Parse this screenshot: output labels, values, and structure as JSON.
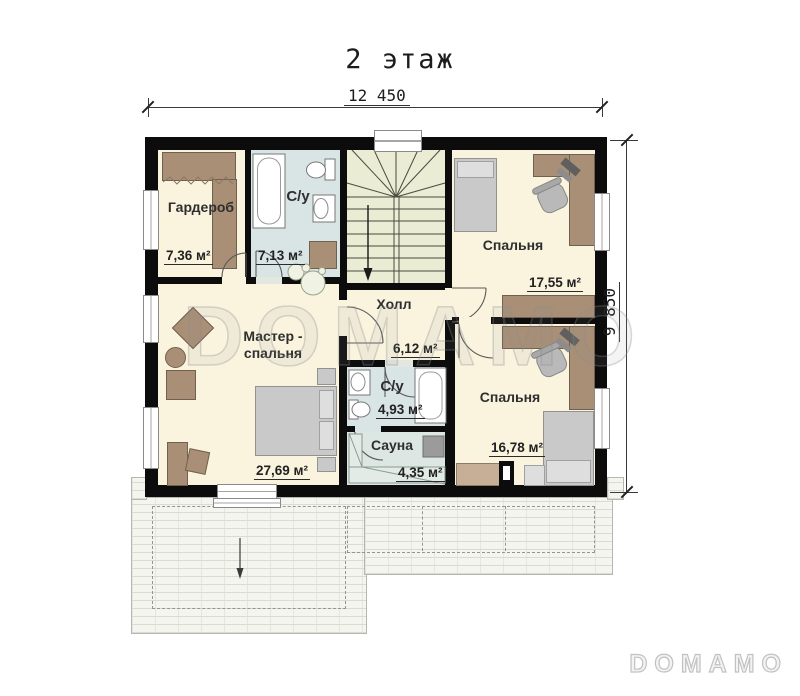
{
  "title": "2 этаж",
  "dimensions": {
    "width": "12 450",
    "height": "9 850"
  },
  "rooms": [
    {
      "name": "Гардероб",
      "area": "7,36 м²"
    },
    {
      "name": "С/у",
      "area": "7,13 м²"
    },
    {
      "name": "Спальня",
      "area": "17,55 м²"
    },
    {
      "name": "Холл",
      "area": "6,12 м²"
    },
    {
      "name": "Мастер -\nспальня",
      "area": "27,69 м²"
    },
    {
      "name": "С/у",
      "area": "4,93 м²"
    },
    {
      "name": "Сауна",
      "area": "4,35 м²"
    },
    {
      "name": "Спальня",
      "area": "16,78 м²"
    }
  ],
  "watermark": "DOMAMO",
  "logo": "DOMAMO",
  "colors": {
    "wall": "#0c0c0c",
    "floor_dry": "#faf4df",
    "floor_wet": "#d9e4e4",
    "floor_stairs": "#eaecd3",
    "furniture_brown": "#a98f76",
    "furniture_gray": "#c9c9c9"
  }
}
